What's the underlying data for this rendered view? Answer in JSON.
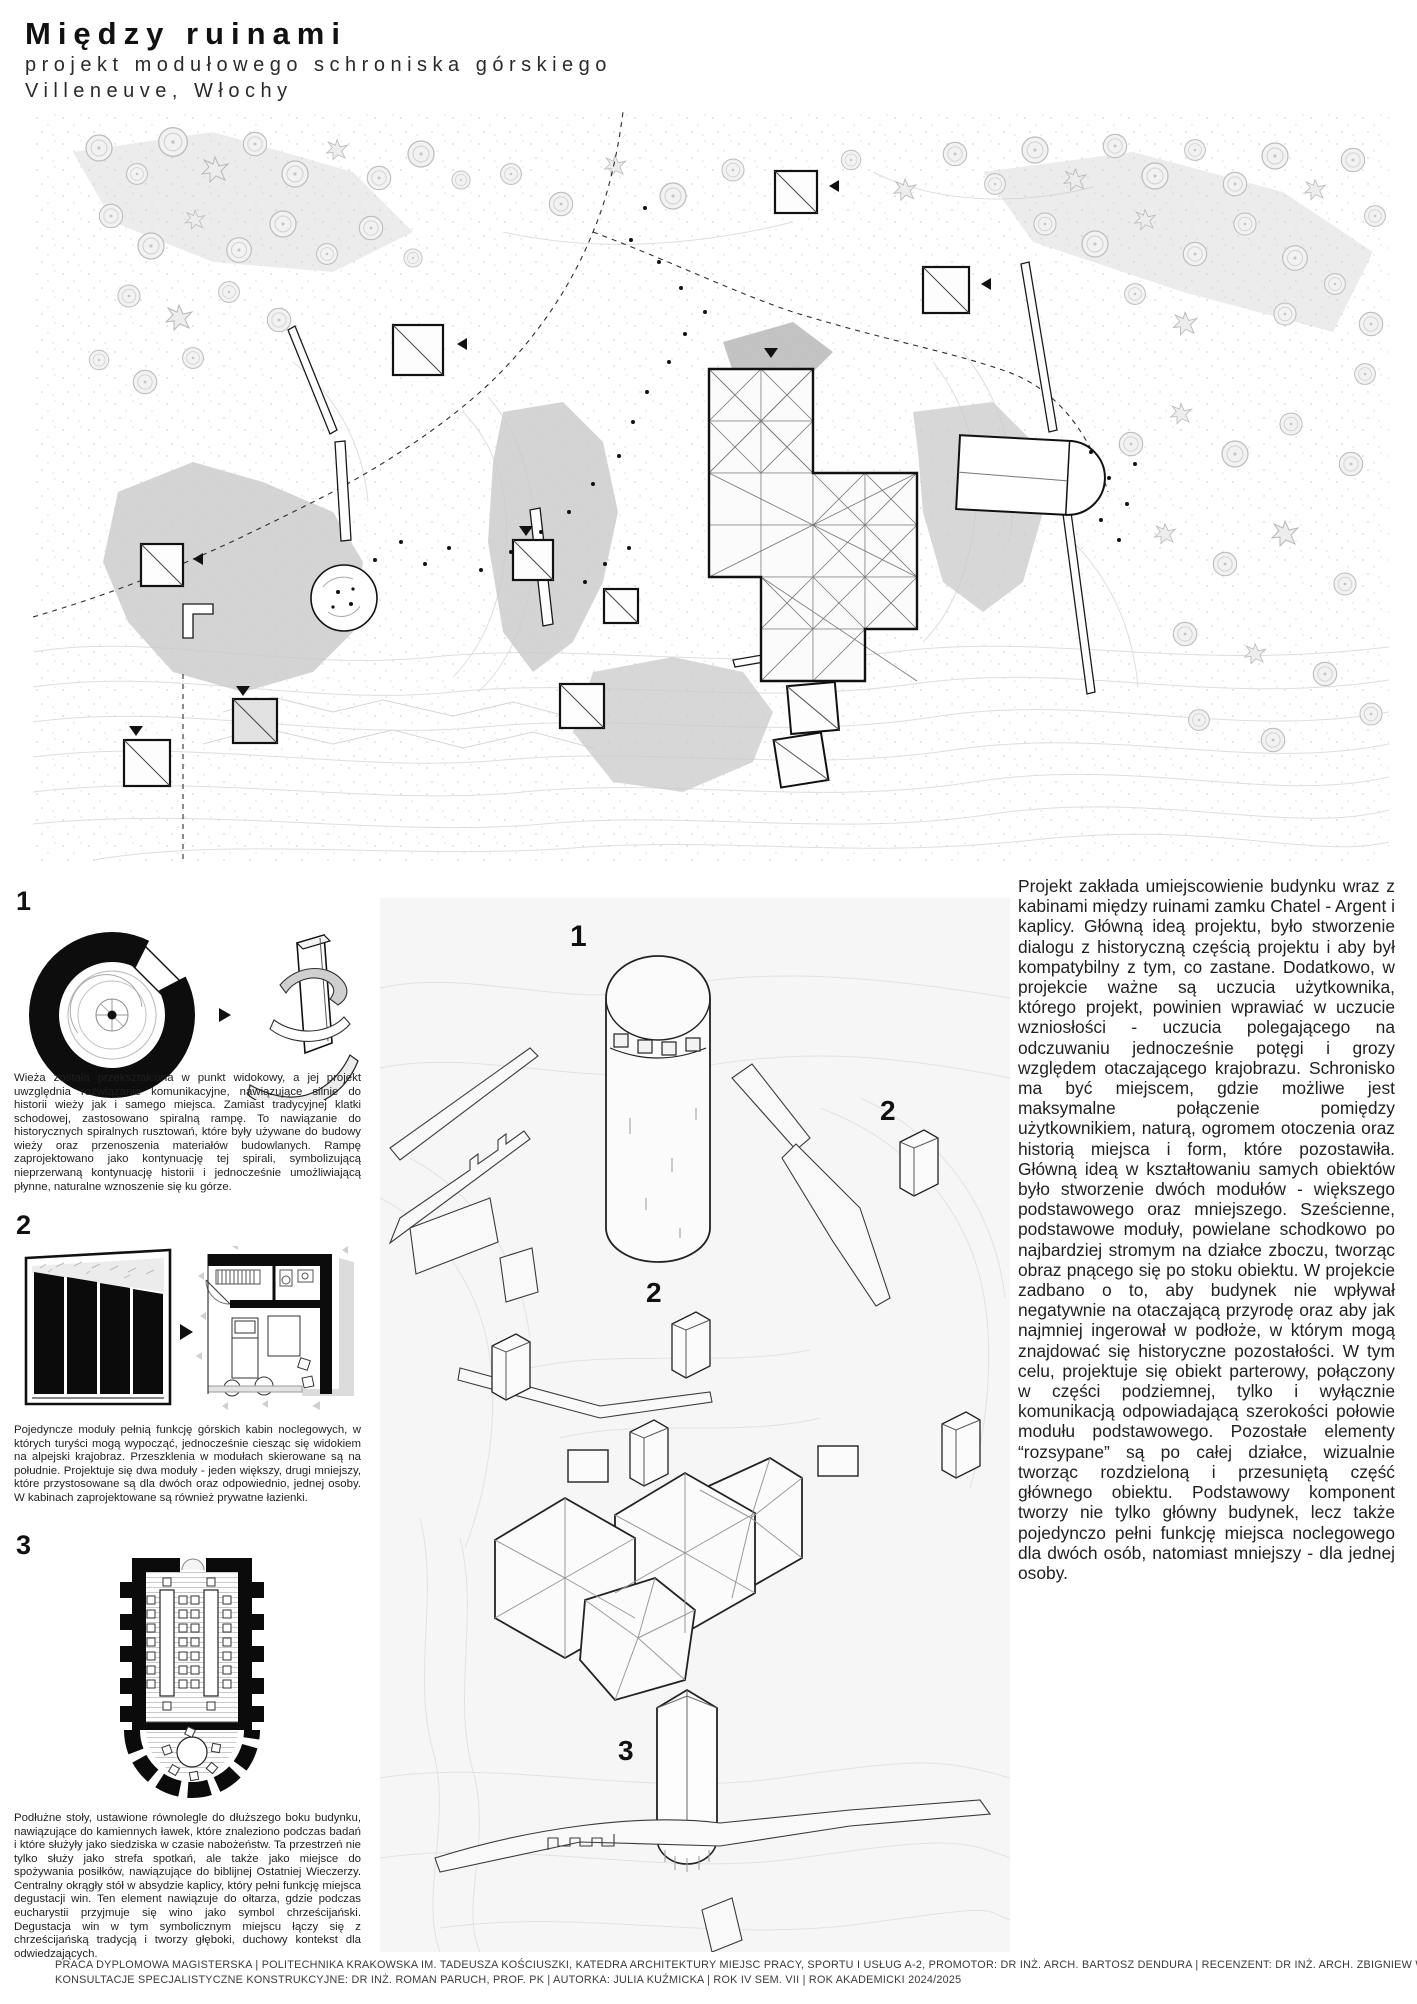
{
  "header": {
    "title": "Między ruinami",
    "subtitle": "projekt modułowego schroniska górskiego",
    "location": "Villeneuve, Włochy"
  },
  "legend_sections": [
    {
      "number": "1",
      "text": "Wieża została przekształcona w punkt widokowy, a jej projekt uwzględnia rozwiązanie komunikacyjne, nawiązujące silnie do historii wieży jak i samego miejsca. Zamiast tradycyjnej klatki schodowej, zastosowano spiralną rampę. To nawiązanie do historycznych spiralnych rusztowań, które były używane do budowy wieży oraz przenoszenia materiałów budowlanych. Rampę zaprojektowano jako kontynuację tej spirali, symbolizującą nieprzerwaną kontynuację historii i jednocześnie umożliwiającą płynne, naturalne wznoszenie się ku górze."
    },
    {
      "number": "2",
      "text": "Pojedyncze moduły pełnią funkcję górskich kabin noclegowych, w których turyści mogą wypocząć, jednocześnie ciesząc się widokiem na alpejski krajobraz. Przeszklenia w modułach skierowane są na południe. Projektuje się dwa moduły - jeden większy, drugi mniejszy, które przystosowane są dla dwóch oraz odpowiednio, jednej osoby. W kabinach zaprojektowane są również prywatne łazienki."
    },
    {
      "number": "3",
      "text": "Podłużne stoły, ustawione równolegle do dłuższego boku budynku, nawiązujące do kamiennych ławek, które znaleziono podczas badań i które służyły jako siedziska w czasie nabożeństw. Ta przestrzeń nie tylko służy jako strefa spotkań, ale także jako miejsce do spożywania posiłków, nawiązujące do biblijnej Ostatniej Wieczerzy. Centralny okrągły stół w absydzie kaplicy, który pełni funkcję miejsca degustacji win. Ten element nawiązuje do ołtarza, gdzie podczas eucharystii przyjmuje się wino jako symbol chrześcijański. Degustacja win w tym symbolicznym miejscu łączy się z chrześcijańską tradycją i tworzy głęboki, duchowy kontekst dla odwiedzających."
    }
  ],
  "axonometric": {
    "label_tower": "1",
    "label_module_large": "2",
    "label_module_small": "2",
    "label_chapel": "3"
  },
  "description": "Projekt zakłada umiejscowienie budynku wraz z kabinami między ruinami zamku Chatel - Argent i kaplicy. Główną ideą projektu, było stworzenie dialogu z historyczną częścią projektu i aby był kompatybilny z tym, co zastane. Dodatkowo, w projekcie ważne są uczucia użytkownika, którego projekt, powinien wprawiać w uczucie wzniosłości - uczucia polegającego na odczuwaniu jednocześnie potęgi i grozy względem otaczającego krajobrazu. Schronisko ma być miejscem, gdzie możliwe jest maksymalne połączenie pomiędzy użytkownikiem, naturą, ogromem otoczenia oraz historią miejsca i form, które pozostawiła. Główną ideą w kształtowaniu samych obiektów było stworzenie dwóch modułów - większego podstawowego oraz mniejszego. Sześcienne, podstawowe moduły, powielane schodkowo po najbardziej stromym na działce zboczu, tworząc obraz pnącego się po stoku obiektu. W projekcie zadbano o to, aby budynek nie wpływał negatywnie na otaczającą przyrodę oraz aby jak najmniej ingerował w podłoże, w którym mogą znajdować się historyczne pozostałości. W tym celu, projektuje się obiekt parterowy, połączony w części podziemnej, tylko i wyłącznie komunikacją odpowiadającą szerokości połowie modułu podstawowego. Pozostałe elementy “rozsypane” są po całej działce, wizualnie tworząc rozdzieloną i przesuniętą część głównego obiektu. Podstawowy komponent tworzy nie tylko główny budynek, lecz także pojedynczo pełni funkcję miejsca noclegowego dla dwóch osób, natomiast mniejszy - dla jednej osoby.",
  "footer": {
    "line1": "PRACA DYPLOMOWA MAGISTERSKA | POLITECHNIKA KRAKOWSKA IM. TADEUSZA KOŚCIUSZKI, KATEDRA ARCHITEKTURY MIEJSC PRACY, SPORTU I USŁUG A-2, PROMOTOR: DR INŻ. ARCH. BARTOSZ DENDURA | RECENZENT: DR INŻ. ARCH. ZBIGNIEW WIKŁACZ |",
    "line2": "KONSULTACJE SPECJALISTYCZNE KONSTRUKCYJNE: DR INŻ. ROMAN PARUCH, PROF. PK | AUTORKA: JULIA KUŹMICKA | ROK IV SEM. VII | ROK AKADEMICKI 2024/2025"
  },
  "colors": {
    "ink": "#1a1a1a",
    "contour_gray": "#dedede",
    "slope_gray": "#c9c9c9",
    "panel_background": "#f6f6f6"
  }
}
